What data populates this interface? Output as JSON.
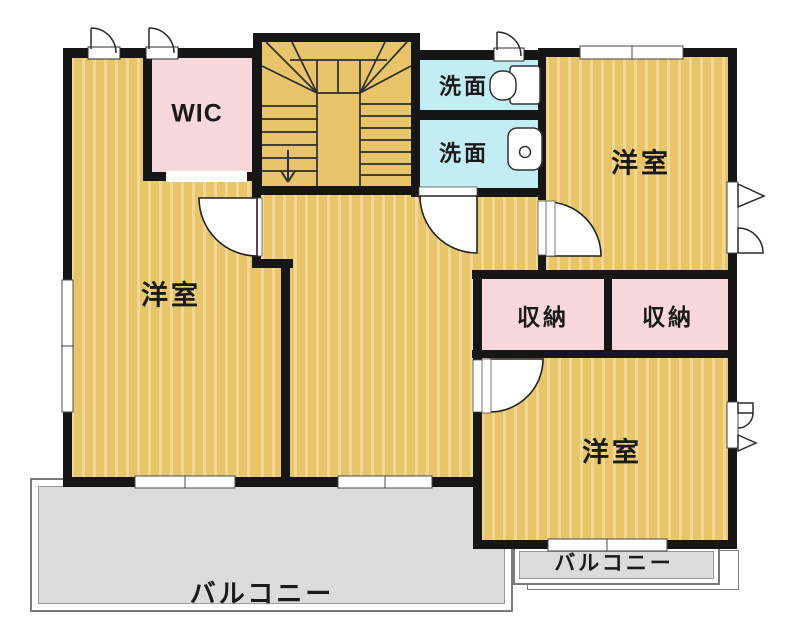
{
  "floorplan": {
    "type": "2F residential floor plan",
    "rooms": {
      "bedroom_left": {
        "label": "洋室"
      },
      "bedroom_top_right": {
        "label": "洋室"
      },
      "bedroom_bottom_right": {
        "label": "洋室"
      },
      "wic": {
        "label": "WIC"
      },
      "washroom_top": {
        "label": "洗面"
      },
      "washroom_bottom": {
        "label": "洗面"
      },
      "storage_left": {
        "label": "収納"
      },
      "storage_right": {
        "label": "収納"
      },
      "balcony_main": {
        "label": "バルコニー"
      },
      "balcony_small": {
        "label": "バルコニー"
      }
    },
    "features": {
      "staircase": "U-shaped stair with winders, down arrow",
      "doors": 4,
      "windows": "sliding and casement window symbols"
    },
    "colors": {
      "room_floor": "#e8c46a",
      "room_floor_stripe": "#f2d894",
      "closet_pink": "#f8d8dd",
      "washroom_blue": "#c2edf5",
      "balcony_gray": "#dbdbdb",
      "wall": "#161616"
    }
  }
}
